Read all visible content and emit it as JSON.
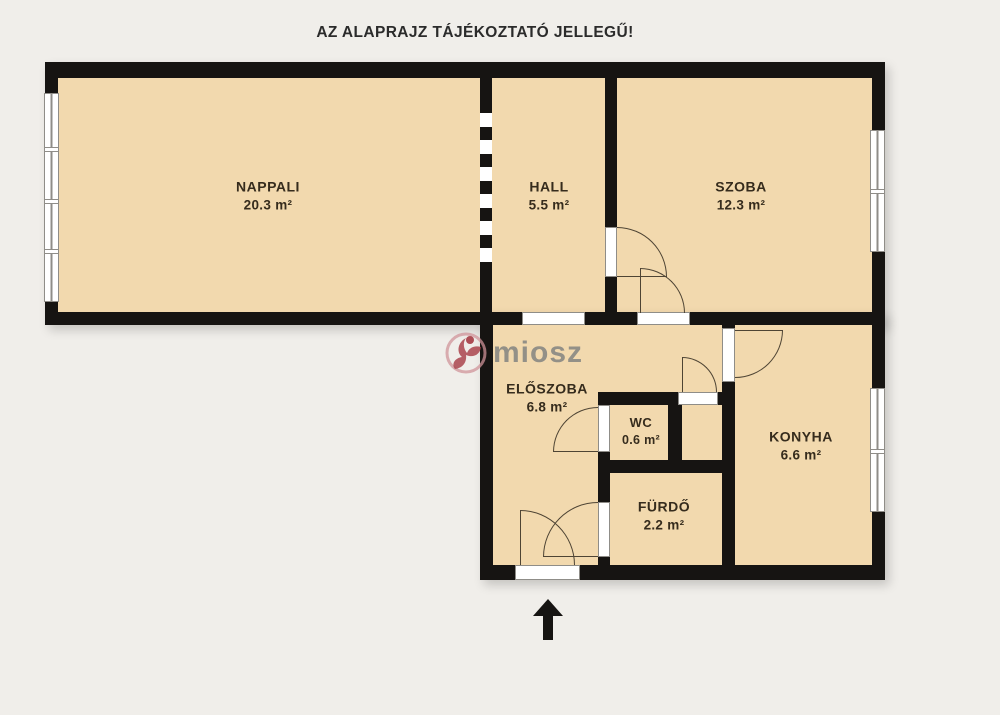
{
  "title": "AZ ALAPRAJZ TÁJÉKOZTATÓ JELLEGŰ!",
  "watermark": {
    "text": "miosz"
  },
  "rooms": {
    "nappali": {
      "name": "NAPPALI",
      "area": "20.3 m²"
    },
    "hall": {
      "name": "HALL",
      "area": "5.5 m²"
    },
    "szoba": {
      "name": "SZOBA",
      "area": "12.3 m²"
    },
    "eloszoba": {
      "name": "ELŐSZOBA",
      "area": "6.8 m²"
    },
    "wc": {
      "name": "WC",
      "area": "0.6 m²"
    },
    "konyha": {
      "name": "KONYHA",
      "area": "6.6 m²"
    },
    "furdo": {
      "name": "FÜRDŐ",
      "area": "2.2 m²"
    }
  },
  "colors": {
    "background": "#f0eeea",
    "floor": "#f2d9ae",
    "wall": "#161412",
    "watermark_text": "#8b8a84",
    "logo_red": "#a84049",
    "logo_pink": "#cf9298"
  }
}
